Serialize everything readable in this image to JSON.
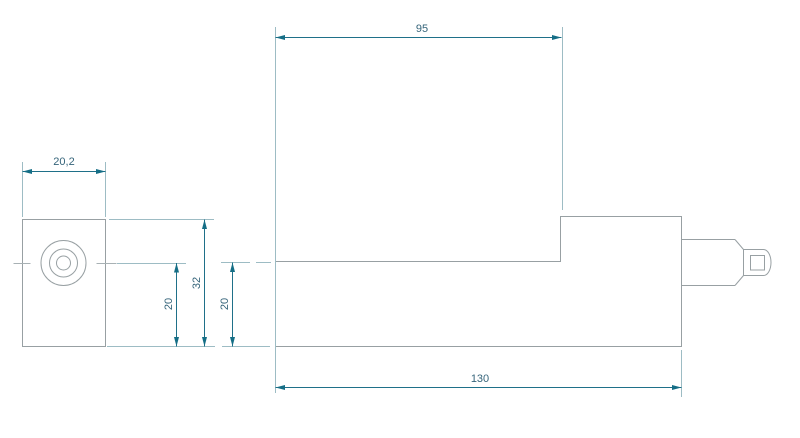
{
  "drawing": {
    "title": "two-view technical dimension drawing of machined block with plug shaft",
    "views": {
      "front_view": "square face with concentric circular boss and hole",
      "side_view": "stepped L-profile block with chamfered cylindrical plug on right end"
    },
    "dimensions": {
      "front_width": "20,2",
      "front_height": "32",
      "front_hole_height": "20",
      "side_step_height": "20",
      "side_upper_length": "95",
      "side_overall_length": "130"
    },
    "colors": {
      "dimension_line": "#1f7089",
      "arrowhead": "#156e86",
      "dimension_text": "#35647a",
      "extension_line": "#9dbcc4",
      "part_outline": "#98a0a3",
      "background": "#ffffff"
    }
  }
}
